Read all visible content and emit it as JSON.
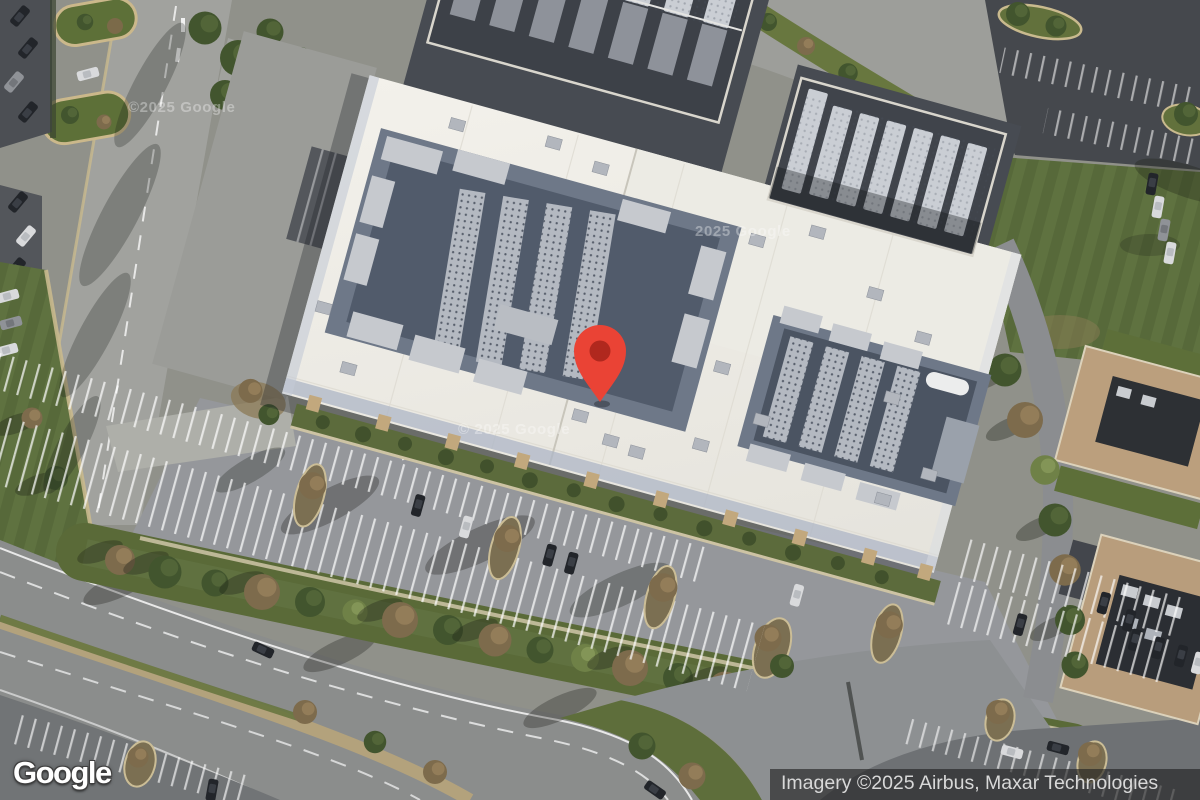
{
  "window": {
    "width": 1200,
    "height": 800,
    "view": "satellite"
  },
  "map": {
    "description": "Aerial satellite view of a large white-roofed building with rooftop HVAC equipment, surrounded by parking lots, roads and lawns",
    "marker": {
      "fill": "#EA4335",
      "dot": "#B0281E"
    },
    "watermarks": [
      "©2025 Google",
      "2025 Google",
      "© 2025 Google"
    ]
  },
  "overlays": {
    "logo": "Google",
    "attribution": "Imagery ©2025 Airbus, Maxar Technologies"
  },
  "colors": {
    "roof_white": "#efede7",
    "asphalt_dark": "#4c4f54",
    "asphalt_light": "#95979b",
    "grass": "#5c6e38",
    "autumn_tree": "#7d6b4c",
    "curb_tan": "#c9ba8e"
  }
}
